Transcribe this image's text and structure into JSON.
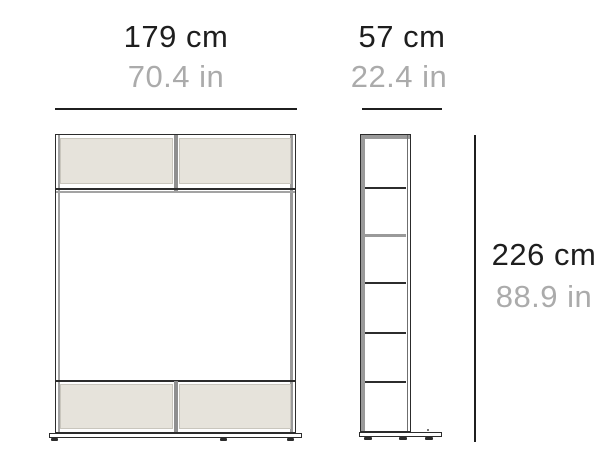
{
  "dimensions": {
    "width": {
      "cm": "179 cm",
      "inches": "70.4 in"
    },
    "depth": {
      "cm": "57 cm",
      "inches": "22.4 in"
    },
    "height": {
      "cm": "226 cm",
      "inches": "88.9 in"
    }
  },
  "colors": {
    "text_primary": "#1e1e1e",
    "text_secondary": "#ababab",
    "outline": "#2c2c2c",
    "secondary_line": "#9a9a9a",
    "panel_fill": "#e6e3db",
    "panel_border": "#c9c6bd",
    "background": "#ffffff"
  }
}
